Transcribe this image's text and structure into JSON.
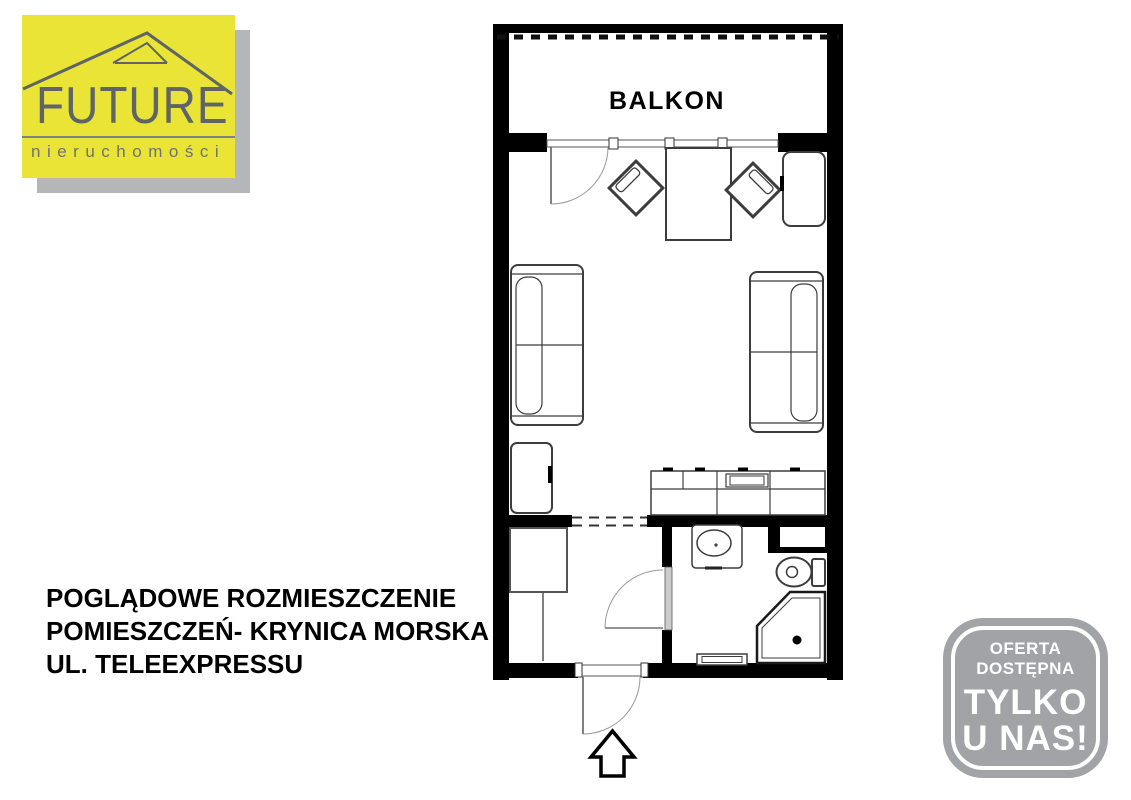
{
  "logo": {
    "brand": "FUTURE",
    "tagline": "nieruchomości",
    "icon": "house-roof-icon",
    "colors": {
      "background": "#e9e435",
      "text": "#5f6468",
      "shadow": "#b5b6b8"
    }
  },
  "caption": {
    "lines": [
      "POGLĄDOWE ROZMIESZCZENIE",
      "POMIESZCZEŃ- KRYNICA MORSKA",
      "UL. TELEEXPRESSU"
    ]
  },
  "floor_plan": {
    "balcony_label": "BALKON",
    "wall_color": "#000000",
    "rooms": [
      "balkon",
      "main-room",
      "hallway",
      "bathroom"
    ],
    "furniture": [
      "balcony-door",
      "dining-table",
      "chair",
      "chair",
      "cabinet",
      "sofa",
      "sofa",
      "low-cabinet",
      "kitchen-counter",
      "wardrobe",
      "bathroom-door",
      "sink-vanity",
      "toilet",
      "corner-shower",
      "mat",
      "entrance-door",
      "entrance-arrow"
    ]
  },
  "badge": {
    "line1": "OFERTA DOSTĘPNA",
    "line2": "TYLKO",
    "line3": "U NAS!",
    "colors": {
      "background": "#a1a3a6",
      "text": "#ffffff"
    }
  }
}
